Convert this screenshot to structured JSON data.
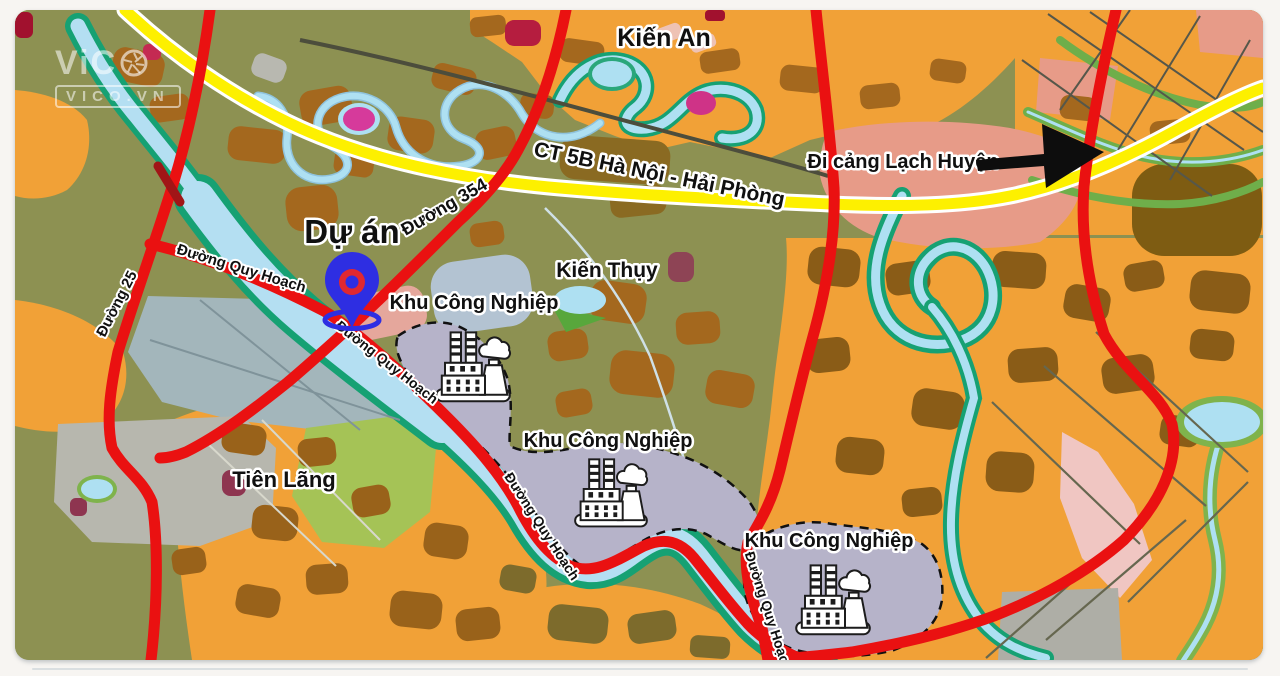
{
  "watermark": {
    "brand_text": "ViC",
    "domain": "VICO.VN"
  },
  "map": {
    "place_labels": {
      "kien_an": "Kiến An",
      "kien_thuy": "Kiến Thụy",
      "tien_lang": "Tiên Lãng"
    },
    "road_labels": {
      "expressway": "CT 5B Hà Nội - Hải Phòng",
      "road_354": "Đường 354",
      "road_25": "Đường 25",
      "planned_road": "Đường Quy Hoạch"
    },
    "annotations": {
      "project": "Dự án",
      "port_direction": "Đi cảng Lạch Huyện",
      "industrial_zone": "Khu Công Nghiệp"
    },
    "colors": {
      "expressway_yellow": "#fdf000",
      "road_red": "#ea1111",
      "water_blue": "#b4dff2",
      "riverbank_teal": "#16a173",
      "industrial_zone_lavender": "#b6b3c9",
      "urban_orange": "#f1a137",
      "farmland_olive": "#8d9152",
      "project_pin_blue": "#2e2ee2",
      "pin_ring_red": "#e02830"
    }
  }
}
